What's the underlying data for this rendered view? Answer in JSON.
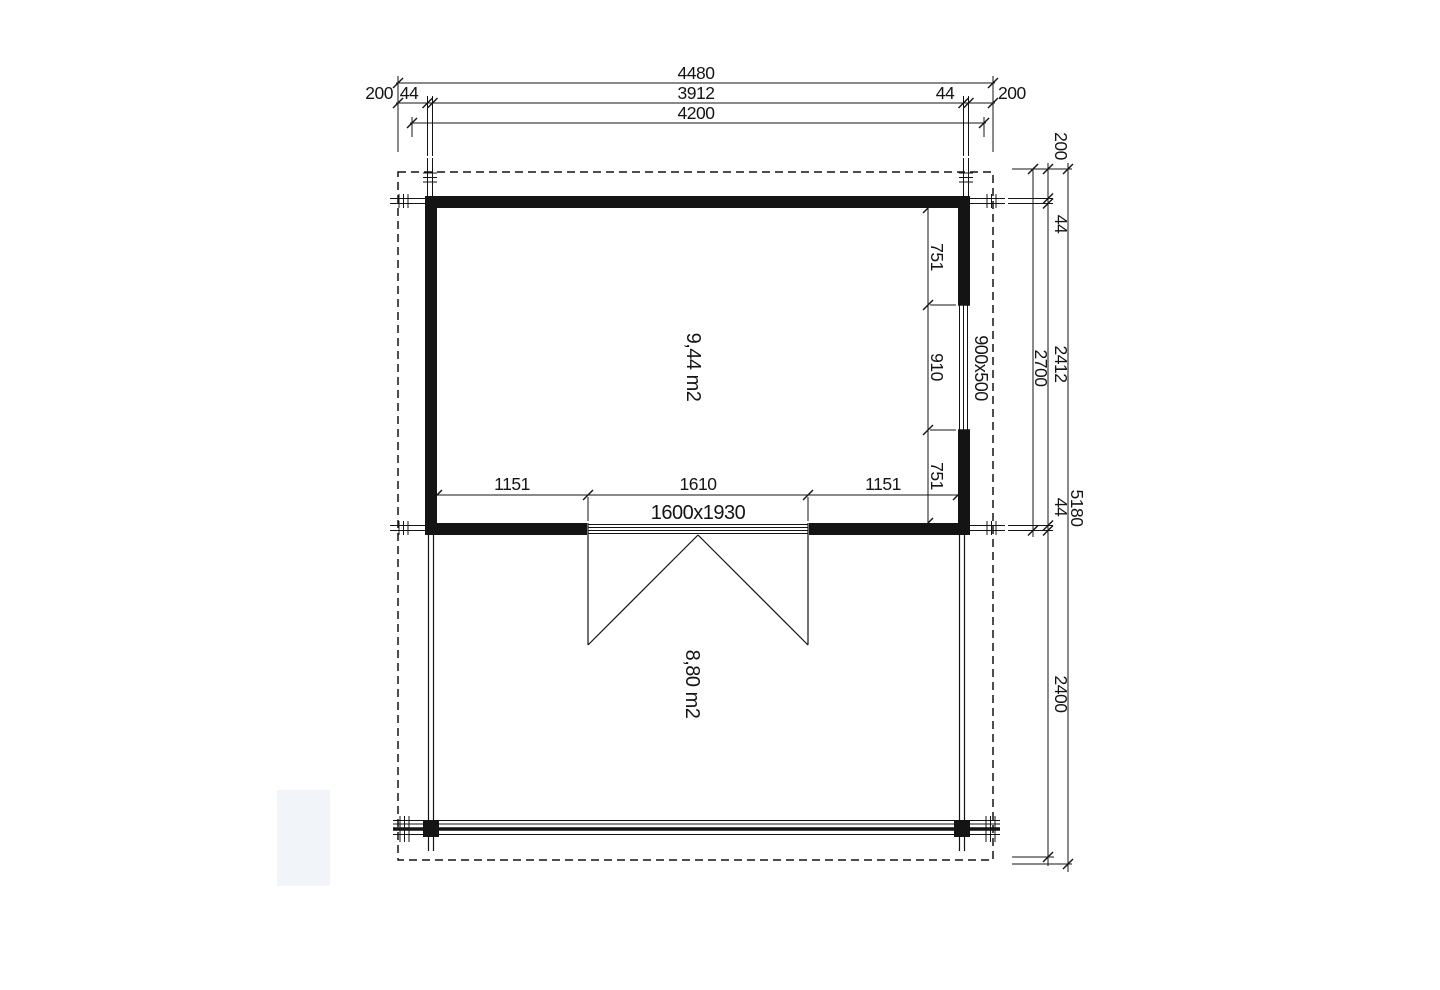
{
  "plan": {
    "title": "log cabin floor plan with terrace",
    "units": "mm",
    "colors": {
      "line": "#141414",
      "background": "#ffffff",
      "watermark": "#f1f4f9"
    },
    "dims": {
      "top": {
        "overall": "4480",
        "overhang_left": "200",
        "wall_left": "44",
        "interior": "3912",
        "wall_right": "44",
        "overhang_right": "200",
        "log_length": "4200"
      },
      "right": {
        "overhang_top": "200",
        "wall_top": "44",
        "interior_depth": "2412",
        "cabin_outer_depth": "2700",
        "wall_bottom": "44",
        "overall_depth": "5180",
        "terrace_depth": "2400"
      },
      "window_wall": {
        "top_offset": "751",
        "window_width": "910",
        "bottom_offset": "751"
      },
      "door_wall": {
        "left_offset": "1151",
        "door_width": "1610",
        "right_offset": "1151"
      }
    },
    "labels": {
      "cabin_area": "9,44 m2",
      "terrace_area": "8,80 m2",
      "window_size": "900x500",
      "door_size": "1600x1930"
    }
  }
}
